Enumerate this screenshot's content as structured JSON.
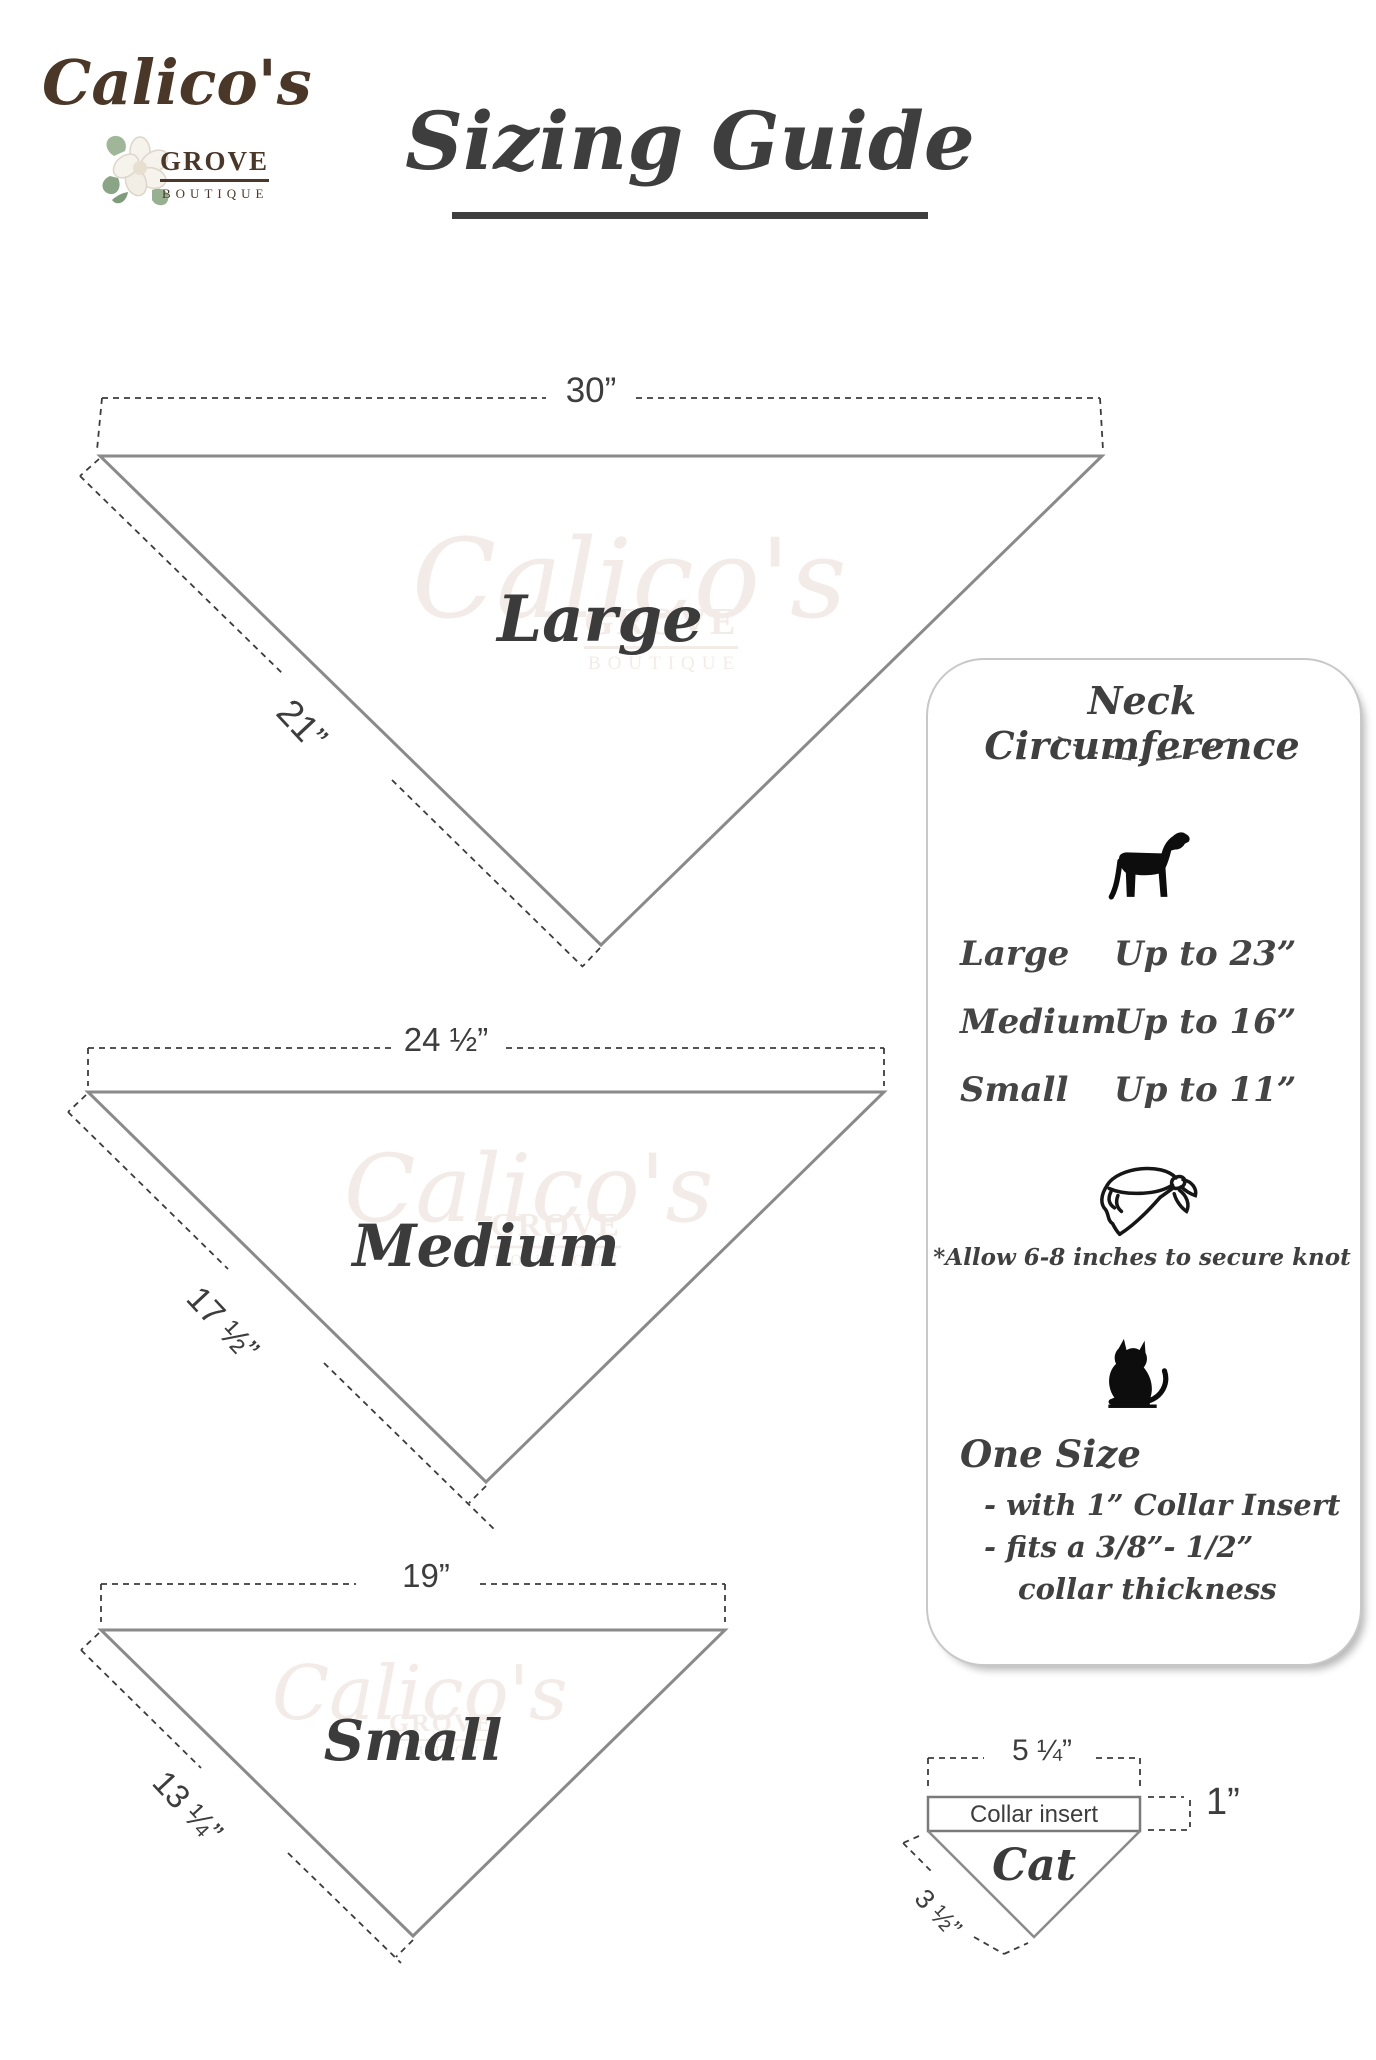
{
  "brand": {
    "name": "Calico's",
    "sub1": "GROVE",
    "sub2": "BOUTIQUE"
  },
  "title": "Sizing Guide",
  "watermark": {
    "script": "Calico's",
    "line1": "GROVE",
    "line2": "BOUTIQUE"
  },
  "bandanas": [
    {
      "label": "Large",
      "top_width": "30”",
      "side_length": "21”"
    },
    {
      "label": "Medium",
      "top_width": "24 ½”",
      "side_length": "17 ½”"
    },
    {
      "label": "Small",
      "top_width": "19”",
      "side_length": "13 ¼”"
    }
  ],
  "panel": {
    "title": "Neck Circumference",
    "dog_sizes": [
      {
        "label": "Large",
        "value": "Up to 23”"
      },
      {
        "label": "Medium",
        "value": "Up to 16”"
      },
      {
        "label": "Small",
        "value": "Up to 11”"
      }
    ],
    "knot_note": "*Allow 6-8 inches to secure knot",
    "one_size": {
      "heading": "One Size",
      "line1": "- with 1” Collar Insert",
      "line2": "- fits a 3/8”- 1/2”",
      "line3": "collar thickness"
    }
  },
  "cat_diagram": {
    "label": "Cat",
    "top_width": "5 ¼”",
    "insert_label": "Collar insert",
    "insert_height": "1”",
    "side_length": "3 ½”"
  },
  "icons": {
    "dog": "dog-silhouette",
    "cat": "cat-silhouette",
    "bandana": "tied-bandana-outline",
    "flower": "magnolia-flower"
  },
  "colors": {
    "brand_brown": "#4a3728",
    "text_dark": "#3d3d3d",
    "line_gray": "#8a8a8a",
    "watermark": "#f3ebe7",
    "panel_border": "#c8c8c8"
  }
}
